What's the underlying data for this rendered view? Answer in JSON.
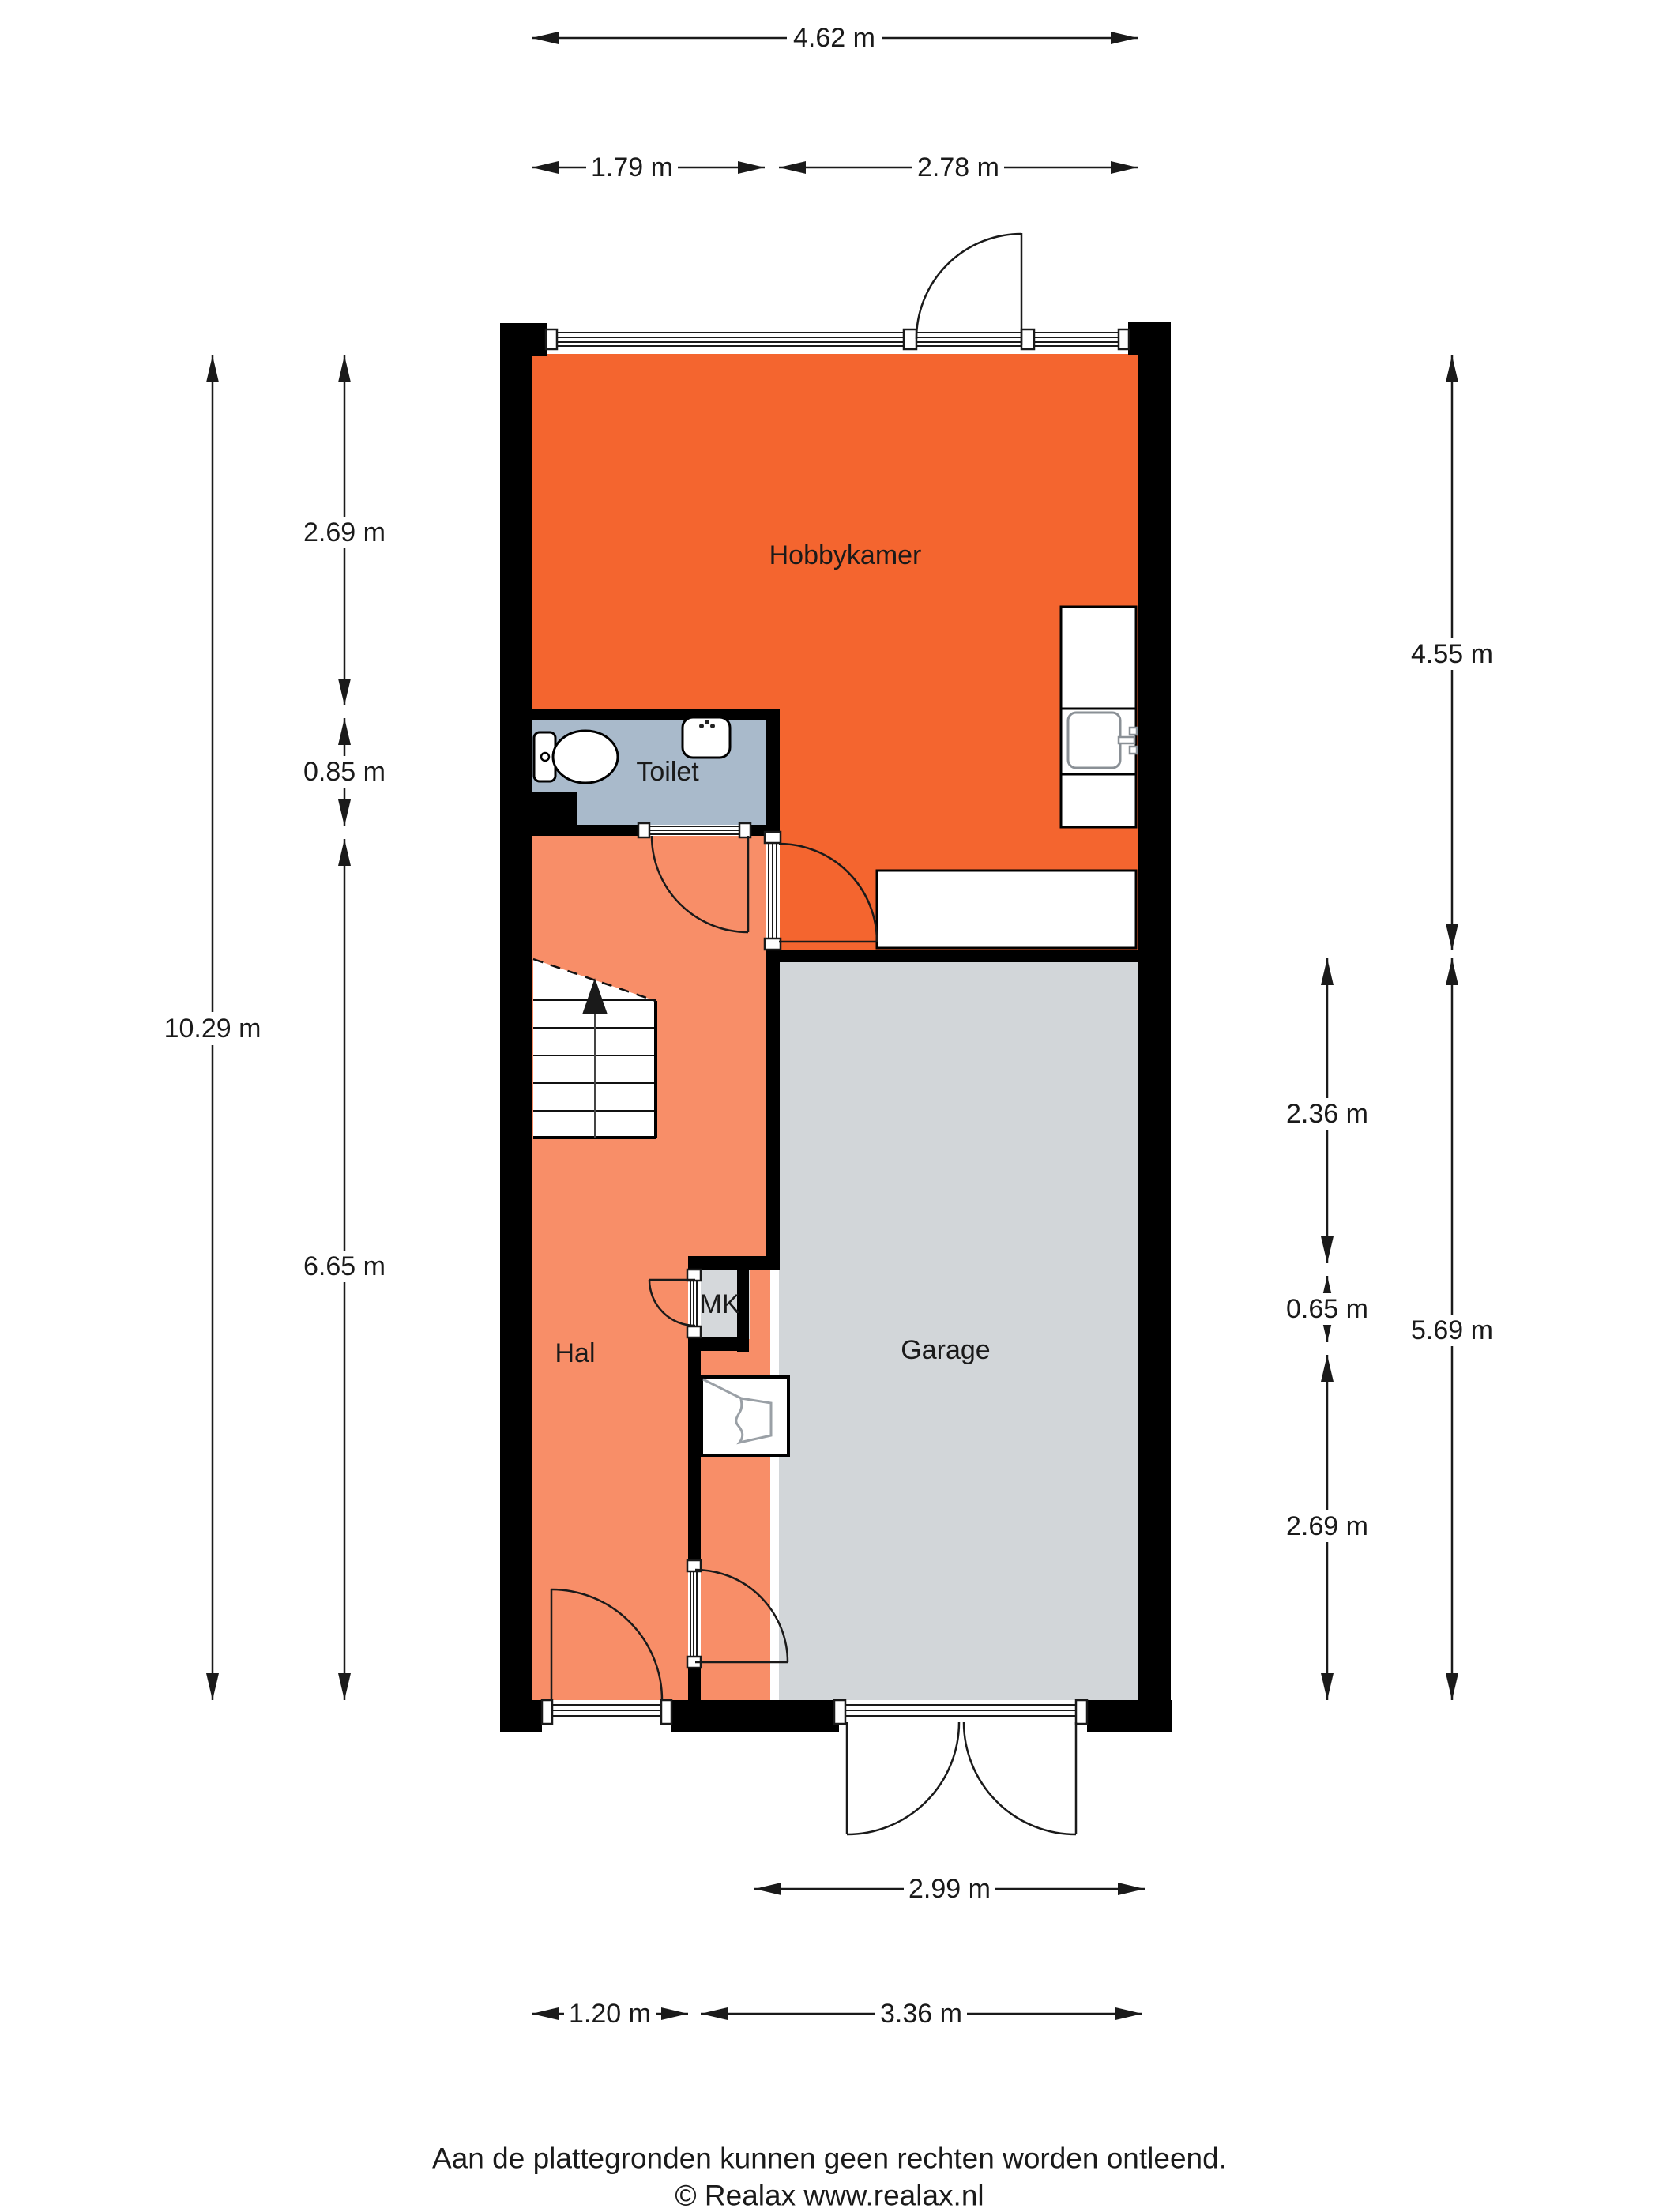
{
  "floorplan": {
    "rooms": [
      {
        "label": "Hobbykamer"
      },
      {
        "label": "Toilet"
      },
      {
        "label": "Hal"
      },
      {
        "label": "MK"
      },
      {
        "label": "Garage"
      }
    ],
    "dimensions": {
      "top_total": "4.62 m",
      "top_left": "1.79 m",
      "top_right": "2.78 m",
      "left_outer": "10.29 m",
      "left_seg_1": "2.69 m",
      "left_seg_2": "0.85 m",
      "left_seg_3": "6.65 m",
      "right_outer_top": "4.55 m",
      "right_outer_bottom": "5.69 m",
      "right_seg_1": "2.36 m",
      "right_seg_2": "0.65 m",
      "right_seg_3": "2.69 m",
      "bottom_door": "2.99 m",
      "bottom_left": "1.20 m",
      "bottom_right": "3.36 m"
    },
    "colors": {
      "hobbykamer": "#f4652f",
      "hal": "#f88e68",
      "garage": "#d2d6d9",
      "mk": "#d5d8db",
      "toilet": "#a9bacb"
    },
    "footer": {
      "line1": "Aan de plattegronden kunnen geen rechten worden ontleend.",
      "line2": "© Realax www.realax.nl"
    }
  }
}
